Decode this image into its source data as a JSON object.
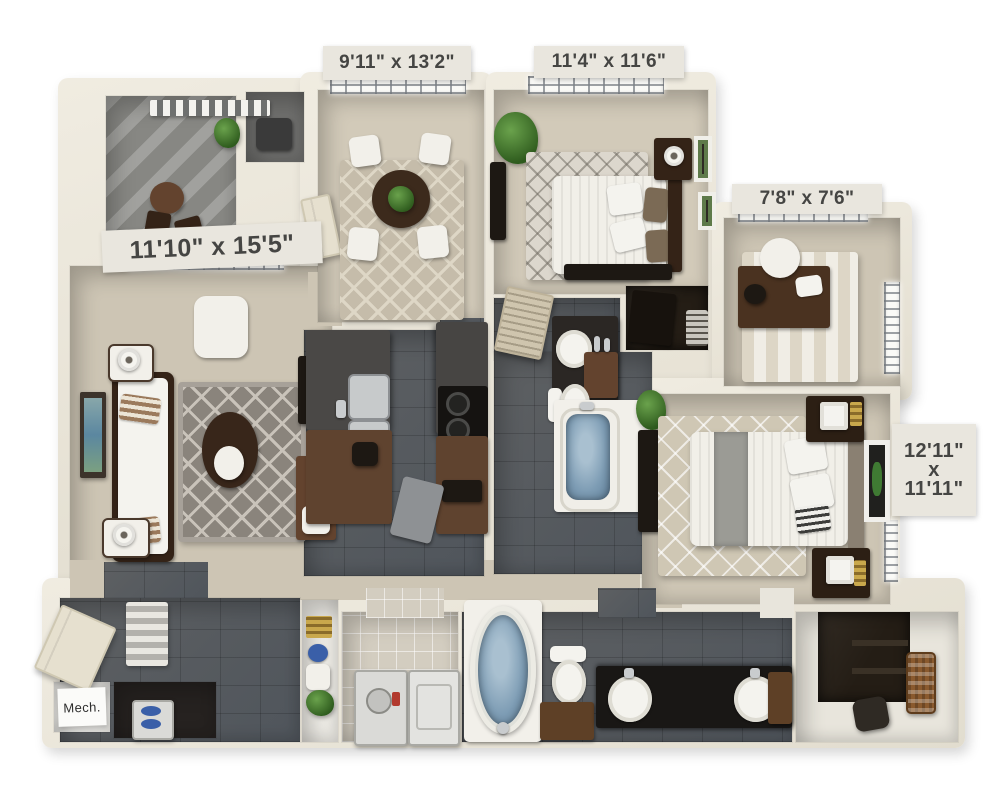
{
  "labels": {
    "dining": "9'11\" x 13'2\"",
    "bedroom2": "11'4\" x 11'6\"",
    "den": "7'8\" x 7'6\"",
    "living": "11'10\" x 15'5\"",
    "master_line1": "12'11\"",
    "master_line2": "x",
    "master_line3": "11'11\"",
    "mech": "Mech."
  },
  "colors": {
    "background": "#ffffff",
    "wall": "#e8e4d8",
    "carpet": "#cdc5b4",
    "slate_tile": "#565b61",
    "balcony_concrete": "#8f8f8b",
    "wood_brown": "#63432e",
    "wood_dark": "#342317",
    "rug_gray": "#8a847c",
    "water_blue": "#7d9cb4",
    "label_bg": "#e9e6de",
    "label_text": "#454543"
  }
}
